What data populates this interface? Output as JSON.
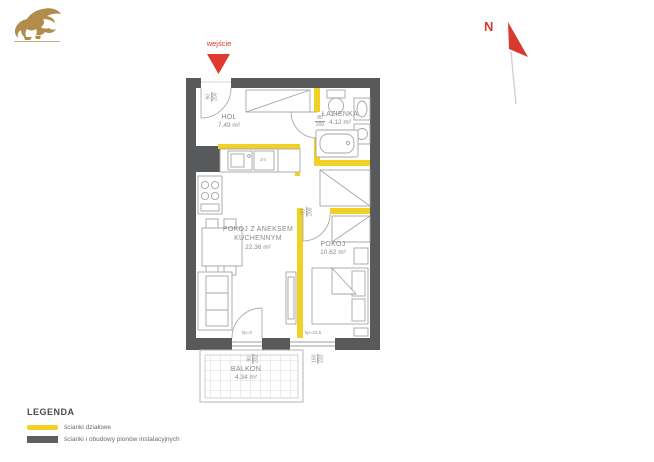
{
  "entrance": {
    "label": "wejście",
    "door": {
      "w": "90",
      "h": "200"
    }
  },
  "compass": {
    "label": "N"
  },
  "rooms": {
    "hol": {
      "name": "HOL",
      "area": "7.49 m²"
    },
    "lazienka": {
      "name": "ŁAZIENKA",
      "area": "4.12 m²",
      "door": {
        "w": "80",
        "h": "200"
      }
    },
    "living": {
      "line1": "POKÓJ Z ANEKSEM",
      "line2": "KUCHENNYM",
      "area": "22.36 m²"
    },
    "pokoj": {
      "name": "POKÓJ",
      "area": "10.62 m²",
      "door": {
        "w": "80",
        "h": "200"
      }
    },
    "balkon": {
      "name": "BALKON",
      "area": "4.34 m²"
    }
  },
  "openings": {
    "balcony_door": {
      "label": "hp=0",
      "w": "90",
      "h": "232"
    },
    "window": {
      "label": "hp=22,5",
      "w": "160",
      "h": "232"
    }
  },
  "kitchen": {
    "dishwasher": "zm"
  },
  "legend": {
    "title": "LEGENDA",
    "items": [
      {
        "label": "ścianki działowe",
        "color": "#f2d125"
      },
      {
        "label": "ścianki i obudowy pionów instalacyjnych",
        "color": "#5f5f5f"
      }
    ]
  },
  "colors": {
    "partition_yellow": "#f2d125",
    "structural_gray": "#58595b",
    "accent_red": "#e0392e",
    "logo_gold": "#b28c4a"
  }
}
